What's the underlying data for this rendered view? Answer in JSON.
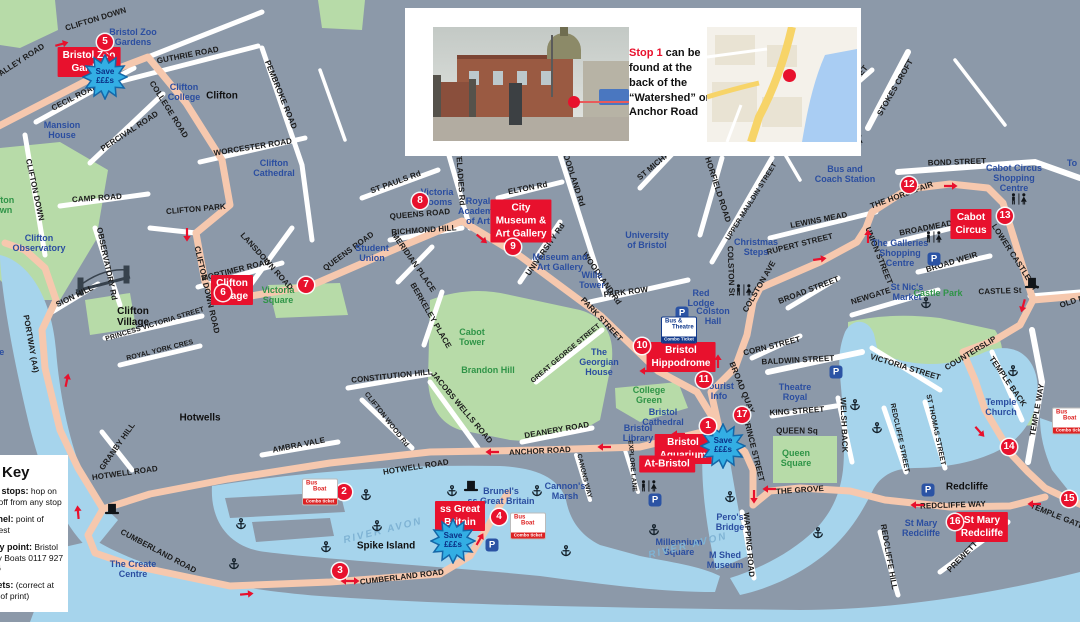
{
  "colors": {
    "background": "#8C99A9",
    "water": "#A6D4EC",
    "park": "#B7DBA8",
    "route": "#F6C8AE",
    "stop_red": "#E8112D",
    "place_blue": "#2B4EA0",
    "place_green": "#2F9447",
    "star_blue": "#33AEE4"
  },
  "inset": {
    "caption_stop": "Stop 1",
    "caption_rest": " can be found at the back of the “Watershed” on Anchor Road"
  },
  "key": {
    "title": "Key",
    "items": [
      {
        "label": "Bus stops:",
        "text": " hop on and off from any stop"
      },
      {
        "label": "Brunel:",
        "text": " point of interest"
      },
      {
        "label": "Ferry point:",
        "text": " Bristol Ferry Boats 0117 927 3416"
      },
      {
        "label": "Toilets:",
        "text": " (correct at time of print)"
      }
    ]
  },
  "star_label": {
    "line1": "Save",
    "line2": "£££s"
  },
  "badges": {
    "combo": {
      "line1": "Bus",
      "line2": "Boat",
      "line3": "Combo ticket",
      "at": [
        [
          320,
          492
        ],
        [
          528,
          526
        ],
        [
          1070,
          421
        ]
      ]
    },
    "theatre": {
      "line1": "Bus &",
      "line2": "Theatre",
      "line3": "Combo Ticket",
      "at": [
        [
          679,
          330
        ]
      ]
    }
  },
  "map": {
    "streets": [
      [
        "CLIFTON DOWN",
        96,
        20,
        -17
      ],
      [
        "VALLEY ROAD",
        20,
        62,
        -33
      ],
      [
        "GUTHRIE ROAD",
        188,
        56,
        -11
      ],
      [
        "PEMBROKE ROAD",
        280,
        95,
        68
      ],
      [
        "CECIL ROAD",
        75,
        98,
        -27
      ],
      [
        "COLLEGE ROAD",
        168,
        110,
        58
      ],
      [
        "PERCIVAL ROAD",
        130,
        132,
        -33
      ],
      [
        "WORCESTER ROAD",
        253,
        148,
        -9
      ],
      [
        "CAMP ROAD",
        97,
        199,
        -4
      ],
      [
        "CLIFTON DOWN",
        34,
        190,
        78
      ],
      [
        "CLIFTON PARK",
        196,
        210,
        -5
      ],
      [
        "OBSERVATORY Rd",
        106,
        264,
        78
      ],
      [
        "LANSDOWN ROAD",
        266,
        262,
        48
      ],
      [
        "MORTIMER ROAD",
        236,
        271,
        -14
      ],
      [
        "CLIFTON DOWN ROAD",
        206,
        290,
        77
      ],
      [
        "QUEENS ROAD",
        349,
        252,
        -36
      ],
      [
        "QUEENS ROAD",
        420,
        215,
        -5
      ],
      [
        "ST PAULS Rd",
        396,
        183,
        -20
      ],
      [
        "WHITELADIES Rd",
        459,
        171,
        86
      ],
      [
        "ELTON Rd",
        528,
        189,
        -11
      ],
      [
        "RICHMOND HILL",
        424,
        231,
        -4
      ],
      [
        "MERIDIAN PLACE",
        413,
        263,
        55
      ],
      [
        "BERKELEY PLACE",
        430,
        316,
        60
      ],
      [
        "UNIVERSITY Rd",
        546,
        250,
        -55
      ],
      [
        "WOODLAND Rd",
        572,
        177,
        72
      ],
      [
        "WOODLAND Rd",
        601,
        279,
        55
      ],
      [
        "ST MICHAELS HILL",
        668,
        155,
        -40
      ],
      [
        "HORFIELD ROAD",
        717,
        190,
        72
      ],
      [
        "UPPER MAULDIN STREET",
        752,
        202,
        -58,
        7
      ],
      [
        "PARK ROW",
        626,
        293,
        -7
      ],
      [
        "PARK STREET",
        601,
        320,
        47
      ],
      [
        "GREAT GEORGE STREET",
        566,
        354,
        -40,
        7
      ],
      [
        "CONSTITUTION HILL",
        392,
        377,
        -6
      ],
      [
        "CLIFTON WOOD Rd",
        386,
        420,
        52,
        7
      ],
      [
        "JACOBS WELLS ROAD",
        461,
        408,
        50
      ],
      [
        "DEANERY ROAD",
        557,
        431,
        -10
      ],
      [
        "ANCHOR ROAD",
        540,
        452,
        -3
      ],
      [
        "HOTWELL ROAD",
        416,
        468,
        -9
      ],
      [
        "HOTWELL ROAD",
        125,
        474,
        -8
      ],
      [
        "GRANBY HILL",
        118,
        447,
        -55
      ],
      [
        "AMBRA VALE",
        299,
        446,
        -11
      ],
      [
        "PORTWAY (A4)",
        30,
        344,
        80
      ],
      [
        "SION HILL",
        75,
        297,
        -26
      ],
      [
        "PRINCESS VICTORIA STREET",
        155,
        325,
        -17,
        7
      ],
      [
        "ROYAL YORK CRES",
        160,
        351,
        -14,
        7
      ],
      [
        "CUMBERLAND ROAD",
        402,
        578,
        -7
      ],
      [
        "CUMBERLAND ROAD",
        158,
        552,
        28
      ],
      [
        "COLSTON St",
        730,
        271,
        88
      ],
      [
        "COLSTON AVE",
        760,
        287,
        -60
      ],
      [
        "LEWINS MEAD",
        819,
        221,
        -11
      ],
      [
        "RUPERT STREET",
        800,
        245,
        -14
      ],
      [
        "BROAD STREET",
        809,
        291,
        -21
      ],
      [
        "NEWGATE",
        871,
        297,
        -17
      ],
      [
        "UNION STREET",
        878,
        256,
        68
      ],
      [
        "BOND STREET",
        957,
        163,
        -2
      ],
      [
        "STOKES CROFT",
        896,
        88,
        -60
      ],
      [
        "JAMAICA STREET",
        845,
        95,
        -52
      ],
      [
        "THE HORSEFAIR",
        902,
        196,
        -20
      ],
      [
        "BROADMEAD",
        926,
        229,
        -11
      ],
      [
        "BROAD WEIR",
        952,
        263,
        -17
      ],
      [
        "CASTLE St",
        1000,
        292,
        -2
      ],
      [
        "LOWER CASTLE ST",
        1014,
        258,
        57
      ],
      [
        "VICTORIA STREET",
        905,
        368,
        17
      ],
      [
        "COUNTERSLIP",
        971,
        354,
        -31
      ],
      [
        "TEMPLE BACK",
        1007,
        382,
        55
      ],
      [
        "TEMPLE WAY",
        1038,
        410,
        -80
      ],
      [
        "ST THOMAS STREET",
        935,
        430,
        78,
        7
      ],
      [
        "REDCLIFFE STREET",
        899,
        438,
        78,
        7
      ],
      [
        "WELSH BACK",
        843,
        425,
        88
      ],
      [
        "REDCLIFFE WAY",
        953,
        506,
        -2
      ],
      [
        "REDCLIFFE HILL",
        888,
        557,
        80
      ],
      [
        "PREWETT STREET",
        975,
        545,
        -46
      ],
      [
        "TEMPLE GATE",
        1057,
        517,
        22
      ],
      [
        "THE GROVE",
        800,
        491,
        -4
      ],
      [
        "WAPPING ROAD",
        748,
        545,
        85
      ],
      [
        "PRINCE STREET",
        753,
        450,
        76
      ],
      [
        "BROAD QUAY",
        741,
        388,
        68
      ],
      [
        "BALDWIN STREET",
        798,
        361,
        -3
      ],
      [
        "CORN STREET",
        772,
        347,
        -14
      ],
      [
        "KING STREET",
        797,
        412,
        -4
      ],
      [
        "QUEEN Sq",
        797,
        432,
        0
      ],
      [
        "CANONS WAY",
        584,
        476,
        76,
        6.5
      ],
      [
        "EXPLORE LANE",
        632,
        466,
        85,
        6.5
      ],
      [
        "OLD MARKET",
        1086,
        298,
        -18
      ]
    ],
    "places": [
      [
        "Bristol Zoo\nGardens",
        133,
        37,
        "b"
      ],
      [
        "Clifton\nCollege",
        184,
        92,
        "b"
      ],
      [
        "Mansion\nHouse",
        62,
        130,
        "b"
      ],
      [
        "Clifton\nCathedral",
        274,
        168,
        "b"
      ],
      [
        "Clifton\nObservatory",
        39,
        243,
        "b"
      ],
      [
        "Victoria\nRooms",
        437,
        197,
        "b"
      ],
      [
        "Royal\nAcademy\nof Art",
        478,
        211,
        "b"
      ],
      [
        "Student\nUnion",
        372,
        253,
        "b"
      ],
      [
        "University\nof Bristol",
        647,
        240,
        "b"
      ],
      [
        "Museum and\nArt Gallery",
        560,
        262,
        "b"
      ],
      [
        "Wills\nTower",
        592,
        280,
        "b"
      ],
      [
        "Red\nLodge",
        701,
        298,
        "b"
      ],
      [
        "Colston\nHall",
        713,
        316,
        "b"
      ],
      [
        "Christmas\nSteps",
        756,
        247,
        "b"
      ],
      [
        "Bus and\nCoach Station",
        845,
        174,
        "b"
      ],
      [
        "Cabot Circus\nShopping Centre",
        1014,
        178,
        "b"
      ],
      [
        "The Galleries\nShopping\nCentre",
        900,
        253,
        "b"
      ],
      [
        "St Nic's\nMarket",
        907,
        292,
        "b"
      ],
      [
        "Theatre\nRoyal",
        795,
        392,
        "b"
      ],
      [
        "Tourist\nInfo",
        719,
        391,
        "b"
      ],
      [
        "Bristol\nCathedral",
        663,
        417,
        "b"
      ],
      [
        "Bristol\nLibrary",
        638,
        433,
        "b"
      ],
      [
        "Millennium\nSquare",
        679,
        547,
        "b"
      ],
      [
        "Cannon's\nMarsh",
        565,
        491,
        "b"
      ],
      [
        "Pero's\nBridge",
        730,
        522,
        "b"
      ],
      [
        "M Shed\nMuseum",
        725,
        560,
        "b"
      ],
      [
        "Temple\nChurch",
        1001,
        407,
        "b"
      ],
      [
        "St Mary\nRedcliffe",
        921,
        528,
        "b"
      ],
      [
        "The Create\nCentre",
        133,
        569,
        "b"
      ],
      [
        "Brunel's\nss Great Britain",
        501,
        496,
        "b"
      ],
      [
        "The\nGeorgian\nHouse",
        599,
        362,
        "b"
      ],
      [
        "Centre",
        -10,
        352,
        "b"
      ],
      [
        "To",
        1072,
        163,
        "b"
      ],
      [
        "Clifton\nDown",
        0,
        205,
        "g"
      ],
      [
        "Castle Park",
        938,
        293,
        "g"
      ],
      [
        "College\nGreen",
        649,
        395,
        "g"
      ],
      [
        "Victoria\nSquare",
        278,
        295,
        "g"
      ],
      [
        "Queen\nSquare",
        796,
        458,
        "g"
      ],
      [
        "Brandon Hill",
        488,
        370,
        "g"
      ],
      [
        "Cabot\nTower",
        472,
        337,
        "g"
      ],
      [
        "Clifton",
        222,
        96,
        "k"
      ],
      [
        "Clifton\nVillage",
        133,
        317,
        "k"
      ],
      [
        "Hotwells",
        200,
        418,
        "k"
      ],
      [
        "Spike Island",
        386,
        546,
        "k"
      ],
      [
        "Redcliffe",
        967,
        487,
        "k"
      ],
      [
        "RIVER AVON",
        383,
        531,
        "w",
        10,
        -14
      ],
      [
        "RIVER AVON",
        688,
        546,
        "w",
        10,
        -14
      ]
    ],
    "stops": [
      [
        1,
        708,
        426
      ],
      [
        2,
        344,
        492
      ],
      [
        3,
        340,
        571
      ],
      [
        4,
        499,
        517
      ],
      [
        5,
        105,
        42
      ],
      [
        6,
        223,
        293
      ],
      [
        7,
        306,
        285
      ],
      [
        8,
        420,
        201
      ],
      [
        9,
        513,
        247
      ],
      [
        10,
        642,
        346
      ],
      [
        11,
        704,
        380
      ],
      [
        12,
        909,
        185
      ],
      [
        13,
        1005,
        216
      ],
      [
        14,
        1009,
        447
      ],
      [
        15,
        1069,
        499
      ],
      [
        16,
        955,
        522
      ],
      [
        17,
        742,
        415
      ]
    ],
    "poi": [
      [
        "Bristol Zoo\nGarden",
        89,
        62
      ],
      [
        "Clifton\nVillage",
        232,
        290
      ],
      [
        "City\nMuseum &\nArt Gallery",
        521,
        221
      ],
      [
        "Bristol\nHippodrome",
        681,
        357
      ],
      [
        "Bristol\nAquarium",
        683,
        449
      ],
      [
        "At-Bristol",
        667,
        464
      ],
      [
        "Cabot\nCircus",
        971,
        224
      ],
      [
        "St Mary\nRedcliffe",
        982,
        527
      ],
      [
        "ss Great\nBritain",
        460,
        516
      ]
    ],
    "stars": [
      [
        105,
        77
      ],
      [
        723,
        446
      ],
      [
        453,
        541
      ]
    ],
    "icons": {
      "anchors": [
        [
          366,
          495
        ],
        [
          241,
          524
        ],
        [
          326,
          547
        ],
        [
          234,
          564
        ],
        [
          377,
          526
        ],
        [
          452,
          491
        ],
        [
          537,
          491
        ],
        [
          654,
          530
        ],
        [
          566,
          551
        ],
        [
          730,
          497
        ],
        [
          818,
          533
        ],
        [
          855,
          405
        ],
        [
          877,
          428
        ],
        [
          926,
          303
        ],
        [
          1013,
          371
        ]
      ],
      "toilets": [
        [
          855,
          140
        ],
        [
          744,
          290
        ],
        [
          1019,
          199
        ],
        [
          934,
          237
        ],
        [
          649,
          486
        ]
      ],
      "tophats": [
        [
          112,
          509
        ],
        [
          471,
          486
        ],
        [
          1032,
          283
        ]
      ],
      "parking": [
        [
          682,
          313
        ],
        [
          934,
          259
        ],
        [
          836,
          372
        ],
        [
          928,
          490
        ],
        [
          492,
          545
        ],
        [
          655,
          500
        ]
      ]
    },
    "arrows": [
      [
        62,
        44,
        -15
      ],
      [
        110,
        57,
        35
      ],
      [
        187,
        235,
        90
      ],
      [
        482,
        239,
        40
      ],
      [
        646,
        371,
        180
      ],
      [
        604,
        447,
        180
      ],
      [
        492,
        452,
        180
      ],
      [
        678,
        434,
        180
      ],
      [
        718,
        361,
        -90
      ],
      [
        754,
        497,
        90
      ],
      [
        820,
        259,
        -8
      ],
      [
        868,
        236,
        -90
      ],
      [
        951,
        186,
        0
      ],
      [
        1023,
        306,
        105
      ],
      [
        980,
        432,
        48
      ],
      [
        917,
        505,
        180
      ],
      [
        1034,
        504,
        180
      ],
      [
        769,
        489,
        180
      ],
      [
        78,
        512,
        -95
      ],
      [
        67,
        380,
        -78
      ],
      [
        247,
        594,
        -5
      ],
      [
        480,
        539,
        -60
      ],
      [
        350,
        581,
        0,
        1
      ]
    ]
  }
}
